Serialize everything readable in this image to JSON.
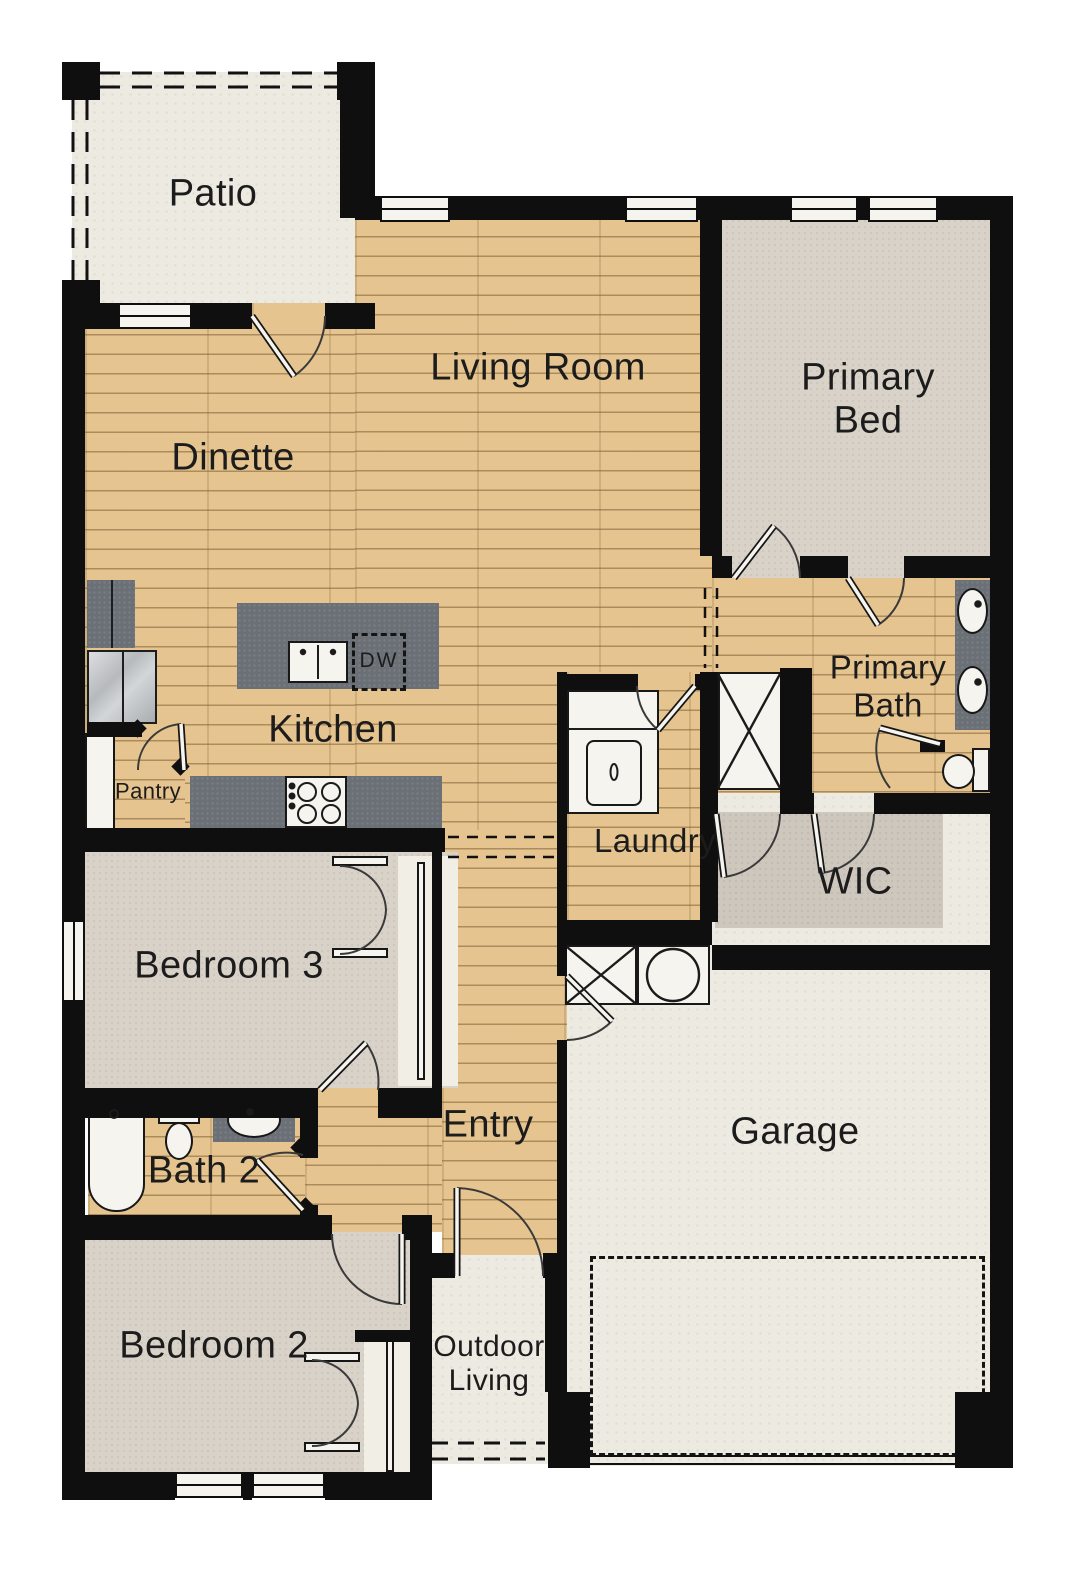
{
  "colors": {
    "wall": "#0f0f0f",
    "wood": "#e5c48f",
    "carpet": "#d9d2c9",
    "carpet_dark": "#cec7bd",
    "hard": "#edeae2",
    "counter": "#6b7077",
    "fixture": "#f6f4ee",
    "text": "#1c1c1c"
  },
  "rooms": {
    "patio": "Patio",
    "dinette": "Dinette",
    "living_room": "Living Room",
    "kitchen": "Kitchen",
    "pantry": "Pantry",
    "laundry": "Laundry",
    "primary_bed": "Primary\nBed",
    "primary_bath": "Primary\nBath",
    "wic": "WIC",
    "bedroom3": "Bedroom 3",
    "bath2": "Bath 2",
    "entry": "Entry",
    "garage": "Garage",
    "bedroom2": "Bedroom 2",
    "outdoor_living": "Outdoor\nLiving"
  },
  "appliances": {
    "dishwasher": "DW"
  }
}
